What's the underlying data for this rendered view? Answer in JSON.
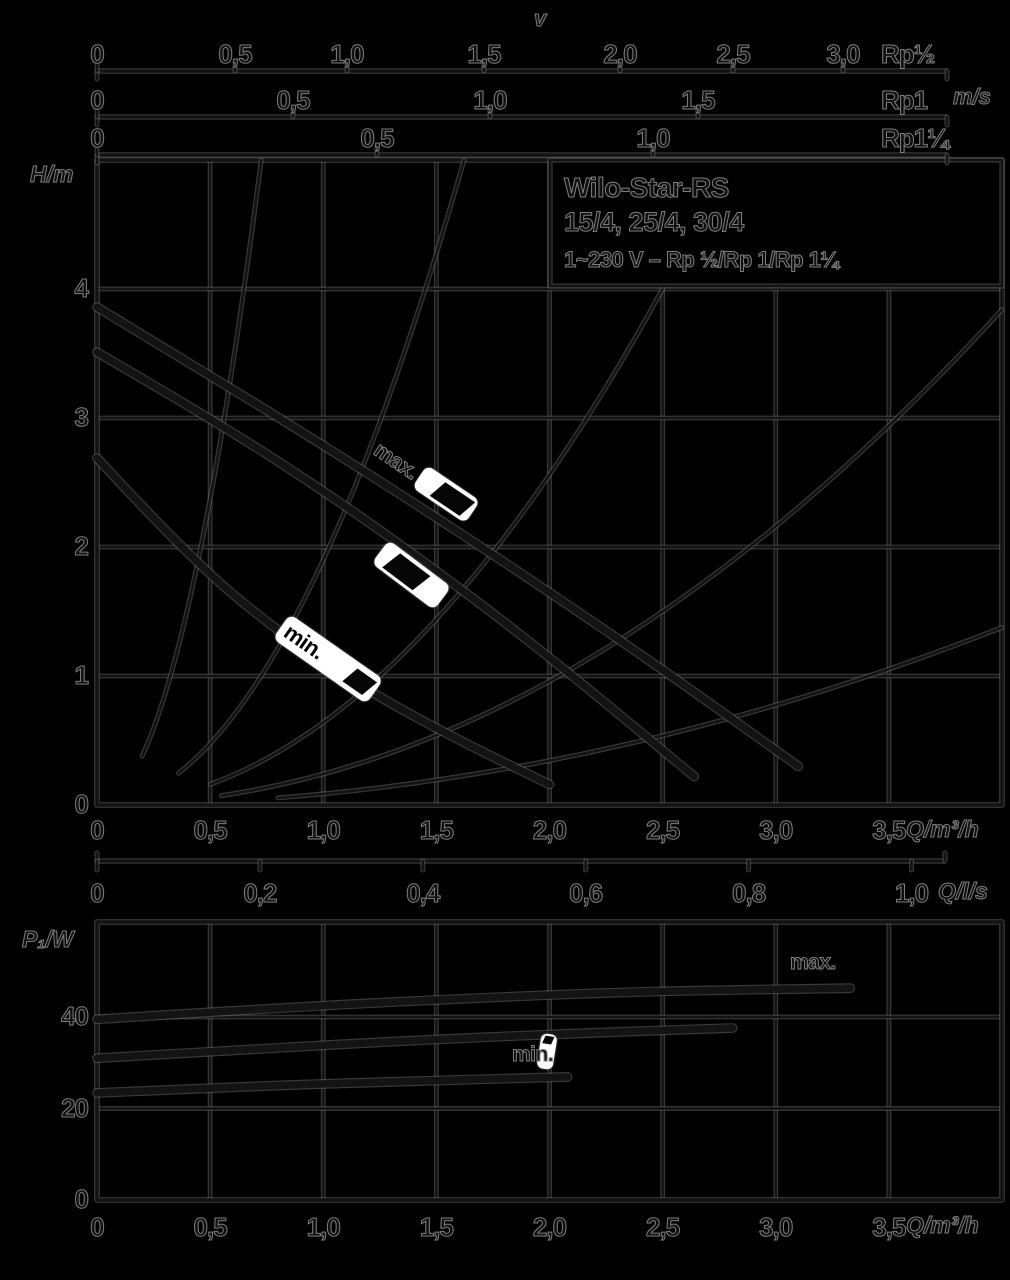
{
  "colors": {
    "background": "#000000",
    "ink_core": "#131313",
    "halo": "#6e6e6e",
    "white": "#ffffff"
  },
  "top_axes": {
    "v_label": "v",
    "unit_label": "m/s",
    "x_start": 97,
    "x_end": 947,
    "rows": [
      {
        "label": "Rp½",
        "y": 71,
        "label_center_y": 55,
        "ticks": [
          {
            "x": 97,
            "t": "0"
          },
          {
            "x": 235,
            "t": "0,5"
          },
          {
            "x": 347,
            "t": "1,0"
          },
          {
            "x": 484,
            "t": "1,5"
          },
          {
            "x": 620,
            "t": "2,0"
          },
          {
            "x": 733,
            "t": "2,5"
          },
          {
            "x": 843,
            "t": "3,0"
          }
        ]
      },
      {
        "label": "Rp1",
        "y": 117,
        "label_center_y": 101,
        "ticks": [
          {
            "x": 97,
            "t": "0"
          },
          {
            "x": 293,
            "t": "0,5"
          },
          {
            "x": 490,
            "t": "1,0"
          },
          {
            "x": 698,
            "t": "1,5"
          }
        ]
      },
      {
        "label": "Rp1¼",
        "y": 155,
        "label_center_y": 139,
        "ticks": [
          {
            "x": 97,
            "t": "0"
          },
          {
            "x": 377,
            "t": "0,5"
          },
          {
            "x": 653,
            "t": "1,0"
          }
        ]
      }
    ]
  },
  "title_box": {
    "line1": "Wilo-Star-RS",
    "line2": "15/4, 25/4, 30/4",
    "line3": "1~230 V – Rp ½/Rp 1/Rp 1¼"
  },
  "main_chart": {
    "ylabel": "H/m",
    "xlabel": "Q/m³/h",
    "yticks": [
      {
        "h": 4,
        "t": "4"
      },
      {
        "h": 3,
        "t": "3"
      },
      {
        "h": 2,
        "t": "2"
      },
      {
        "h": 1,
        "t": "1"
      },
      {
        "h": 0,
        "t": "0"
      }
    ],
    "xticks": [
      {
        "q": 0,
        "t": "0"
      },
      {
        "q": 0.5,
        "t": "0,5"
      },
      {
        "q": 1,
        "t": "1,0"
      },
      {
        "q": 1.5,
        "t": "1,5"
      },
      {
        "q": 2,
        "t": "2,0"
      },
      {
        "q": 2.5,
        "t": "2,5"
      },
      {
        "q": 3,
        "t": "3,0"
      },
      {
        "q": 3.5,
        "t": "3,5"
      }
    ]
  },
  "qls_axis": {
    "label": "Q/l/s",
    "ticks": [
      {
        "v": 0,
        "t": "0"
      },
      {
        "v": 0.2,
        "t": "0,2"
      },
      {
        "v": 0.4,
        "t": "0,4"
      },
      {
        "v": 0.6,
        "t": "0,6"
      },
      {
        "v": 0.8,
        "t": "0,8"
      },
      {
        "v": 1.0,
        "t": "1,0"
      }
    ]
  },
  "power_chart": {
    "ylabel": "P₁/W",
    "xlabel": "Q/m³/h",
    "max_label": "max.",
    "min_label": "min.",
    "yticks": [
      {
        "p": 40,
        "t": "40"
      },
      {
        "p": 20,
        "t": "20"
      },
      {
        "p": 0,
        "t": "0"
      }
    ],
    "xticks": [
      {
        "q": 0,
        "t": "0"
      },
      {
        "q": 0.5,
        "t": "0,5"
      },
      {
        "q": 1,
        "t": "1,0"
      },
      {
        "q": 1.5,
        "t": "1,5"
      },
      {
        "q": 2,
        "t": "2,0"
      },
      {
        "q": 2.5,
        "t": "2,5"
      },
      {
        "q": 3,
        "t": "3,0"
      },
      {
        "q": 3.5,
        "t": "3,5"
      }
    ]
  },
  "markers": {
    "max_flag_text": "max.",
    "min_flag_text": "min."
  },
  "chart_data": [
    {
      "type": "line",
      "title": "Pump head curves",
      "xlabel": "Q/m³/h",
      "ylabel": "H/m",
      "xlim": [
        0,
        4
      ],
      "ylim": [
        0,
        5
      ],
      "grid": true,
      "series": [
        {
          "name": "max",
          "points": [
            [
              0,
              3.86
            ],
            [
              0.5,
              3.33
            ],
            [
              1.0,
              2.79
            ],
            [
              1.5,
              2.23
            ],
            [
              2.0,
              1.65
            ],
            [
              2.5,
              1.05
            ],
            [
              3.1,
              0.3
            ]
          ]
        },
        {
          "name": "mid",
          "points": [
            [
              0,
              3.51
            ],
            [
              0.5,
              3.0
            ],
            [
              1.0,
              2.44
            ],
            [
              1.5,
              1.82
            ],
            [
              2.0,
              1.15
            ],
            [
              2.64,
              0.22
            ]
          ]
        },
        {
          "name": "min",
          "points": [
            [
              0,
              2.69
            ],
            [
              0.4,
              1.93
            ],
            [
              0.8,
              1.34
            ],
            [
              1.2,
              0.88
            ],
            [
              1.6,
              0.5
            ],
            [
              2.0,
              0.16
            ]
          ]
        }
      ],
      "system_curves": [
        {
          "a": 9.5,
          "q0": 0.2,
          "q1": 0.726
        },
        {
          "a": 1.9,
          "q0": 0.36,
          "q1": 1.622
        },
        {
          "a": 0.64,
          "q0": 0.5,
          "q1": 2.509
        },
        {
          "a": 0.24,
          "q0": 0.55,
          "q1": 4.0
        },
        {
          "a": 0.086,
          "q0": 0.8,
          "q1": 4.0
        }
      ]
    },
    {
      "type": "line",
      "title": "Power input curves",
      "xlabel": "Q/m³/h",
      "ylabel": "P₁/W",
      "xlim": [
        0,
        4
      ],
      "ylim": [
        0,
        60
      ],
      "grid": true,
      "series": [
        {
          "name": "max",
          "points": [
            [
              0,
              39.5
            ],
            [
              0.8,
              42.0
            ],
            [
              1.6,
              44.0
            ],
            [
              2.4,
              45.6
            ],
            [
              3.33,
              46.3
            ]
          ]
        },
        {
          "name": "mid",
          "points": [
            [
              0,
              31.0
            ],
            [
              0.7,
              33.0
            ],
            [
              1.4,
              34.9
            ],
            [
              2.1,
              36.4
            ],
            [
              2.81,
              37.6
            ]
          ]
        },
        {
          "name": "min",
          "points": [
            [
              0,
              23.4
            ],
            [
              0.7,
              24.9
            ],
            [
              1.4,
              26.0
            ],
            [
              2.08,
              26.9
            ]
          ]
        }
      ]
    }
  ]
}
